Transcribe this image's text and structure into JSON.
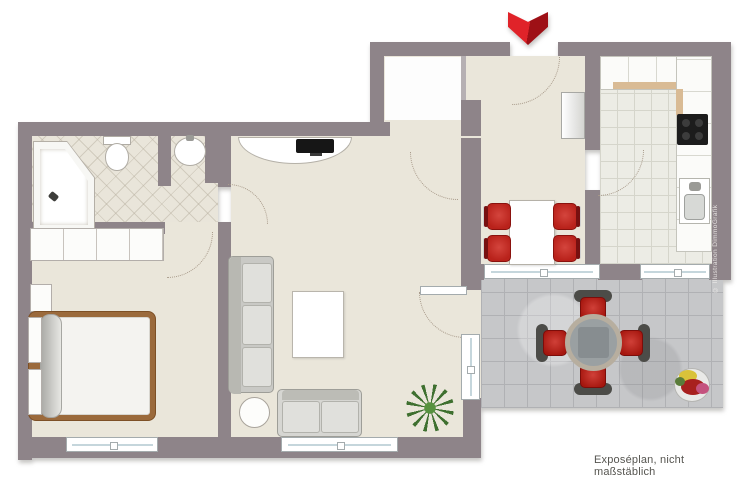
{
  "labels": {
    "caption": "Exposéplan, nicht maßstäblich",
    "credit": "© Illustration DimmoGrafik"
  },
  "icons": [
    {
      "name": "entrance-arrow-icon",
      "shape": "double-chevron-down",
      "color": "#d9232a"
    }
  ],
  "colors": {
    "wall": "#8e8489",
    "floor_beige": "#eae6da",
    "bathroom_tile": "#e9e5da",
    "kitchen_tile": "#ecece5",
    "terrace_tile": "#c6c7c9",
    "accent_red": "#c32b24",
    "accent_red_dark": "#9e1016",
    "wood_brown": "#9b6a3c",
    "counter_edge_tan": "#d9bb95",
    "window_frame": "#a4abad",
    "caption_text": "#565550"
  }
}
